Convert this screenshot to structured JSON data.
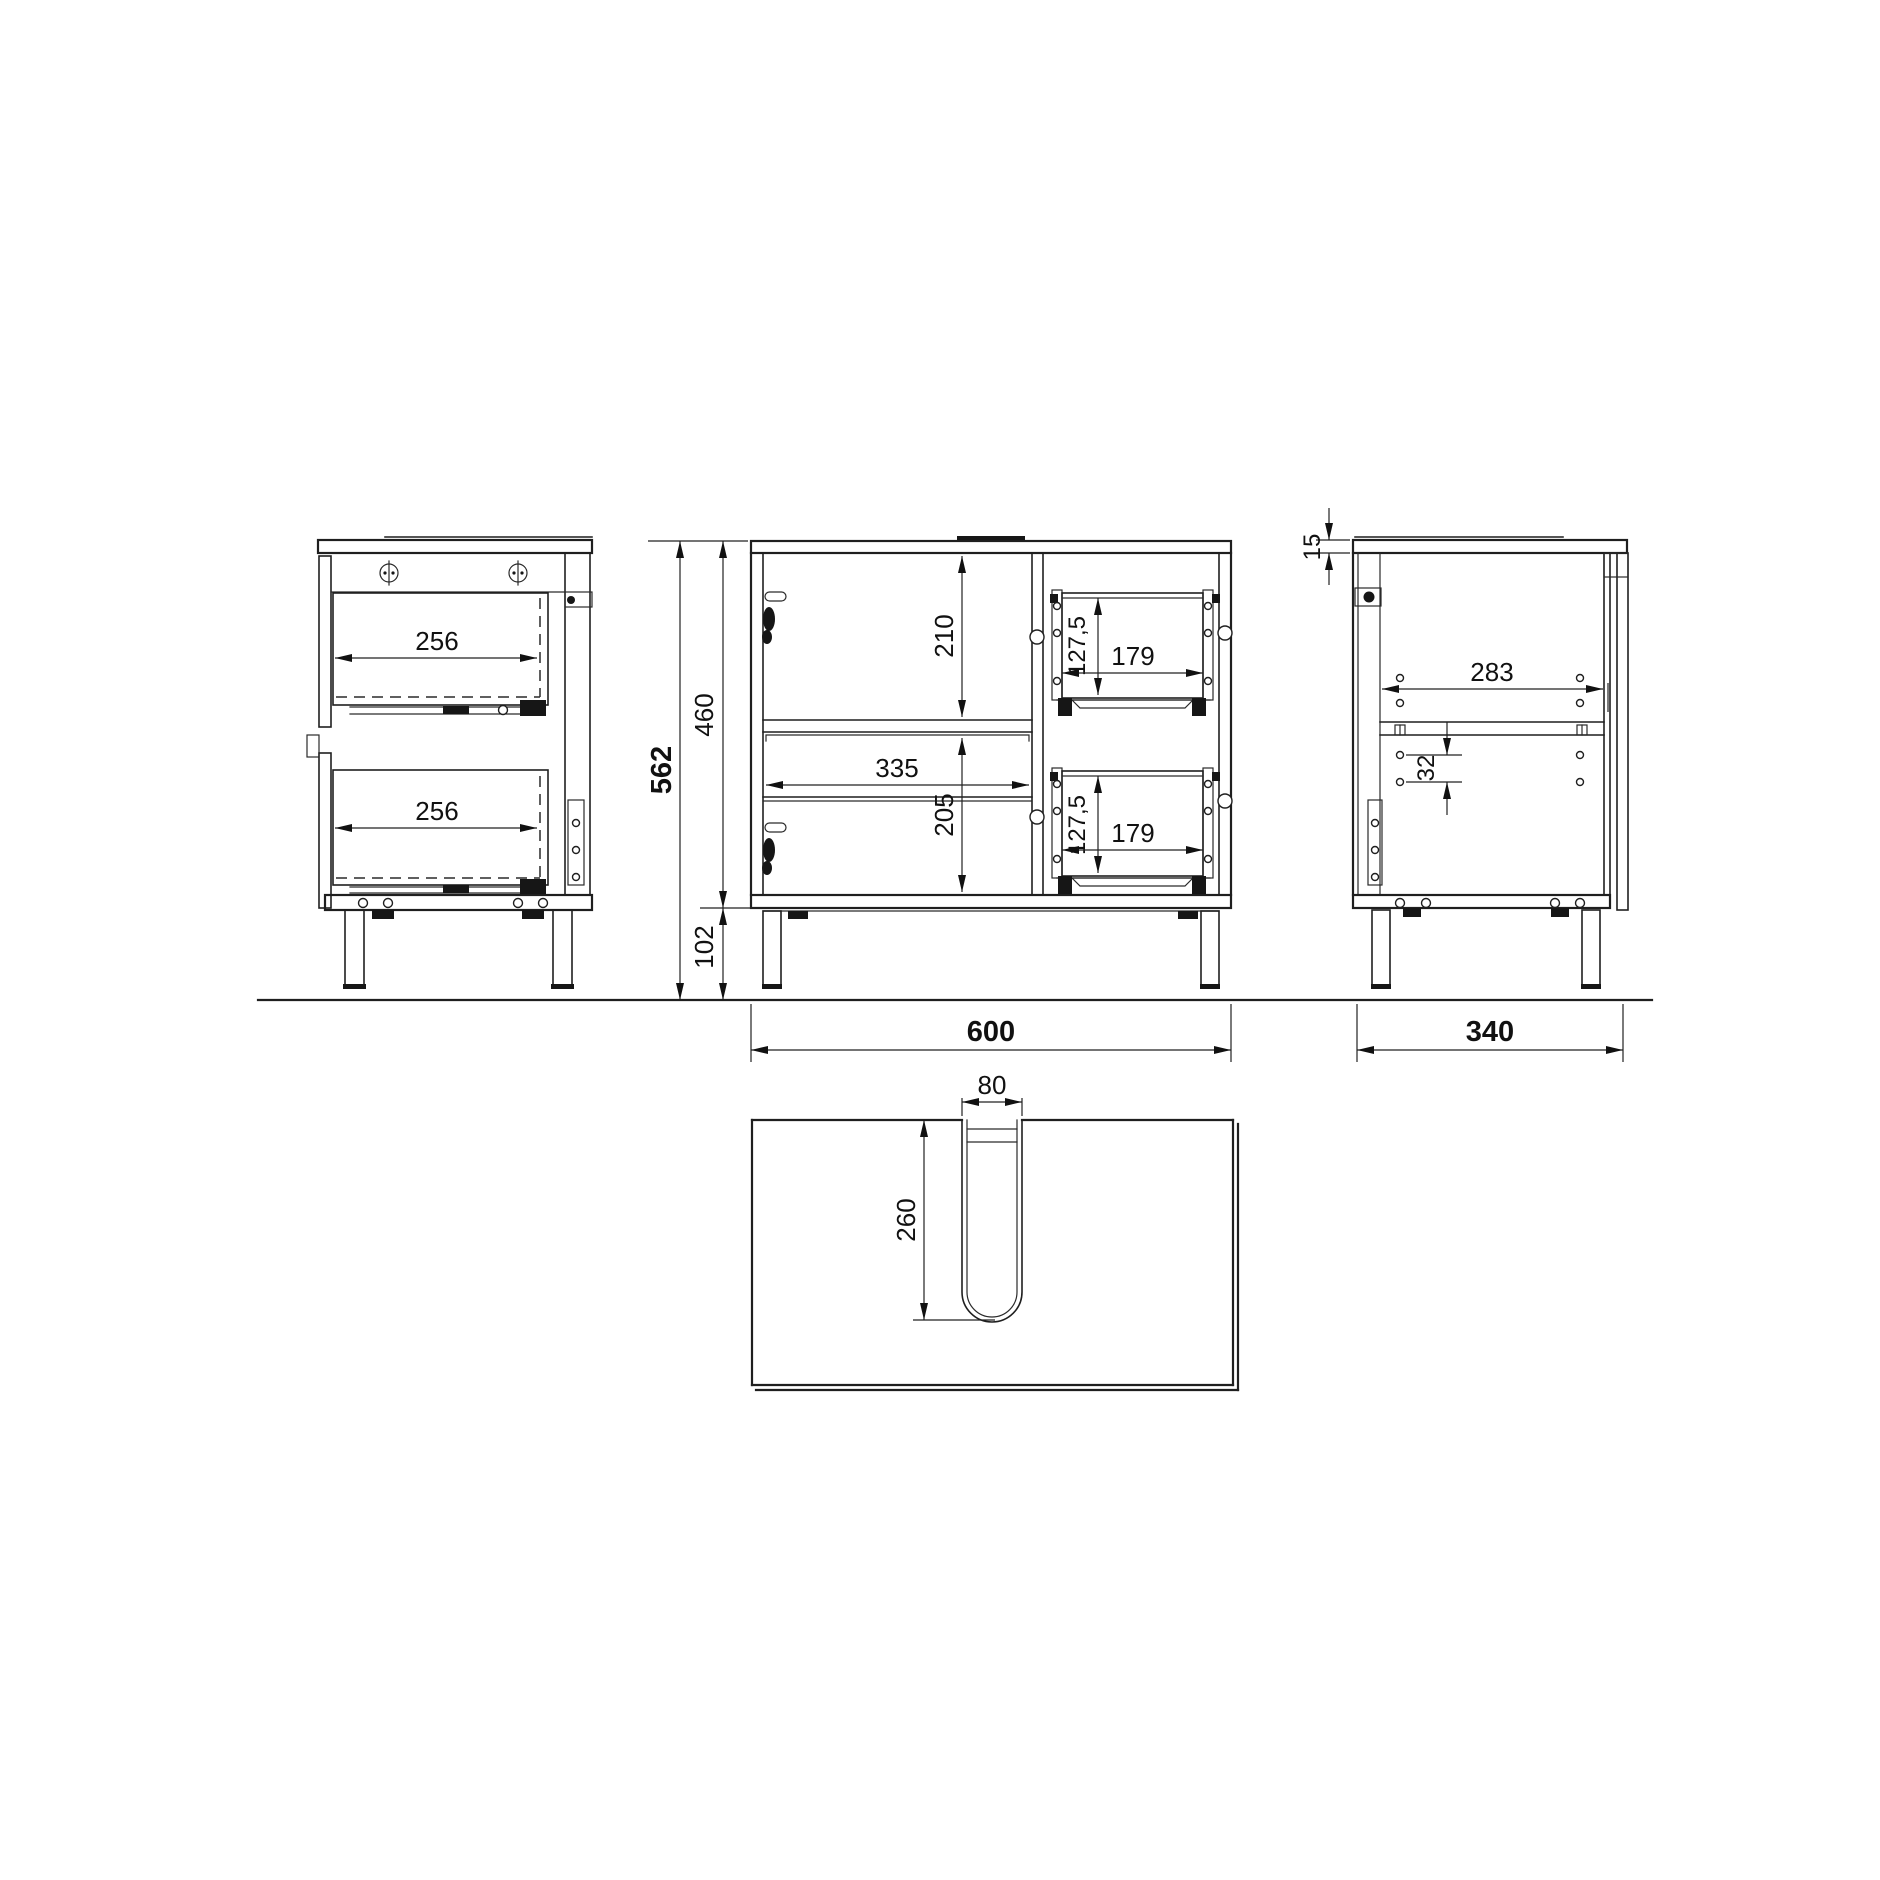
{
  "drawing": {
    "kind": "furniture technical drawing",
    "units": "mm",
    "views": {
      "side_section": {
        "label": "side section view",
        "dims": {
          "top_drawer_depth": "256",
          "bottom_drawer_depth": "256"
        }
      },
      "front": {
        "label": "front section view",
        "dims": {
          "overall_height": "562",
          "carcass_height": "460",
          "leg_height": "102",
          "upper_opening_height": "210",
          "interior_width": "335",
          "lower_opening_height": "205",
          "top_drawer_height": "127,5",
          "top_drawer_width": "179",
          "bottom_drawer_height": "127,5",
          "bottom_drawer_width": "179",
          "overall_width": "600"
        }
      },
      "side_right": {
        "label": "right side view",
        "dims": {
          "top_panel_thickness": "15",
          "back_rail_width": "283",
          "hole_spacing": "32",
          "overall_depth": "340"
        }
      },
      "top_view": {
        "label": "top view with plumbing cutout",
        "dims": {
          "cutout_width": "80",
          "cutout_depth": "260"
        }
      }
    }
  }
}
